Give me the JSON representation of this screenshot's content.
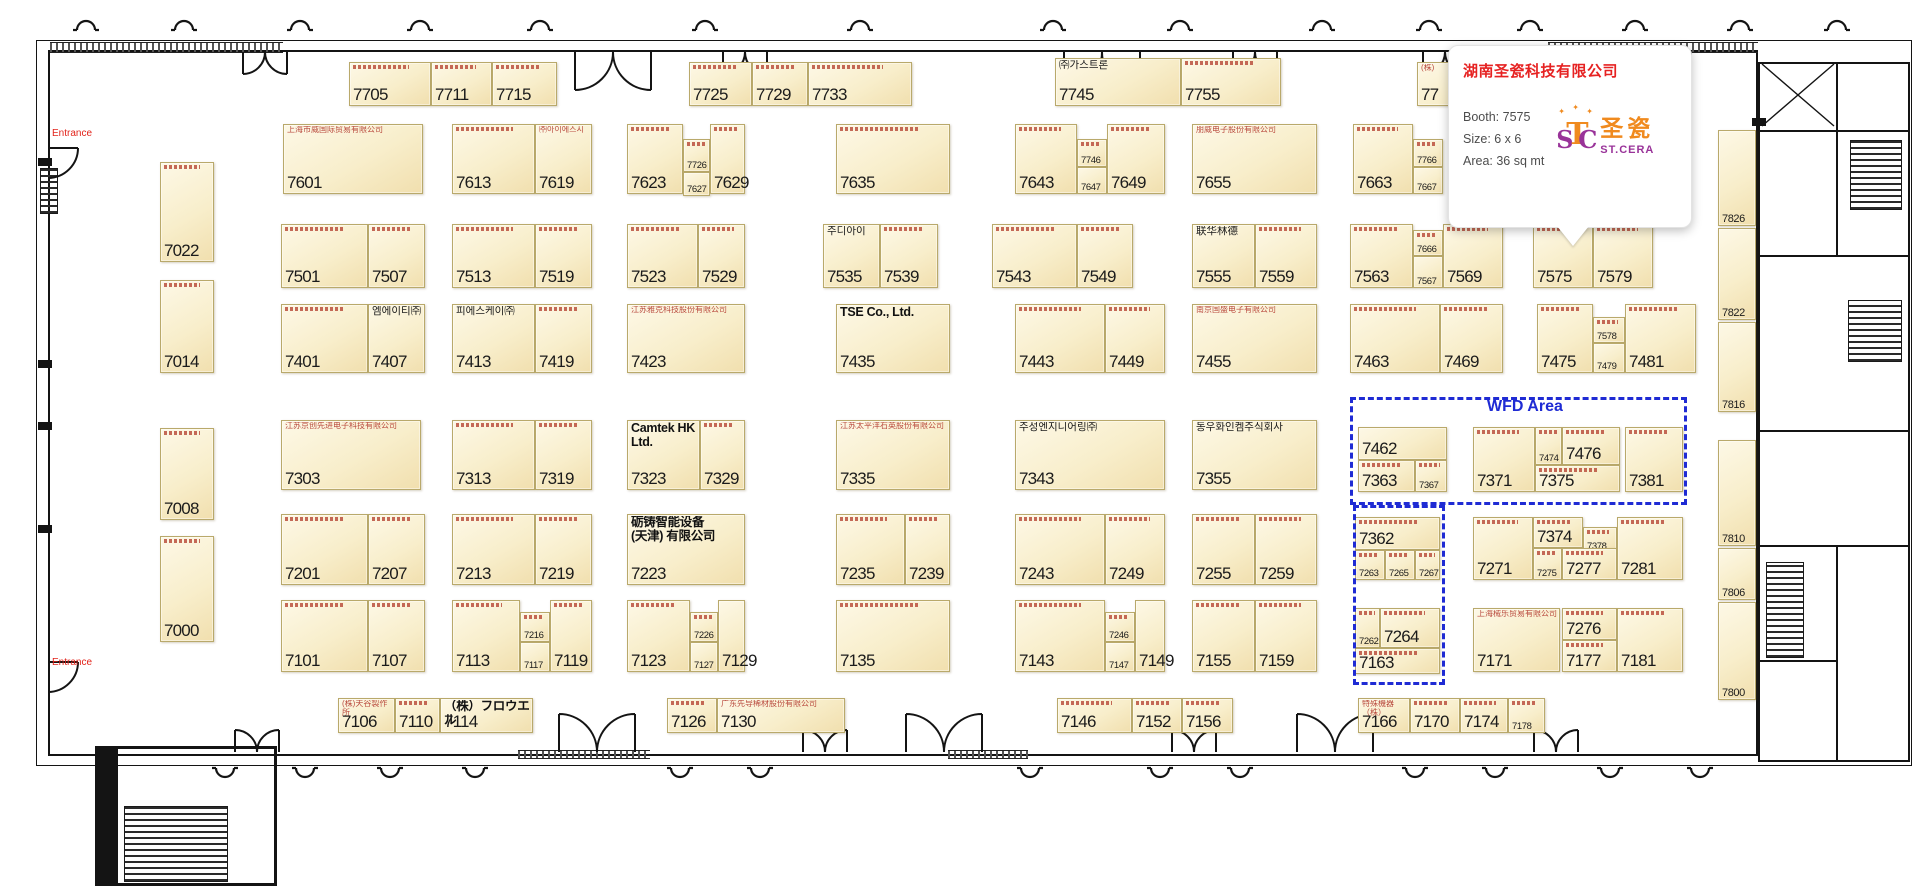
{
  "colors": {
    "dash_blue": "#1f2bd4",
    "entrance_red": "#e2231a",
    "tooltip_title_red": "#e62222",
    "logo_orange": "#f08a1e",
    "logo_purple": "#993399",
    "booth_fill": "#f8eecb",
    "booth_border": "#b9a96b"
  },
  "tooltip": {
    "title": "湖南圣瓷科技有限公司",
    "booth": "Booth: 7575",
    "size": "Size: 6 x 6",
    "area": "Area: 36 sq mt",
    "logo_monogram_s": "S",
    "logo_monogram_t": "T",
    "logo_monogram_c": "C",
    "logo_cn": "圣瓷",
    "logo_en": "ST.CERA",
    "spark": "✦"
  },
  "labels": {
    "wfd_area": "WFD Area",
    "entrance_top": "Entrance",
    "entrance_bottom": "Entrance"
  },
  "booths": [
    [
      "7705",
      349,
      62,
      82,
      44,
      "lg",
      null,
      null,
      1
    ],
    [
      "7711",
      431,
      62,
      61,
      44,
      "lg",
      null,
      null,
      1
    ],
    [
      "7715",
      492,
      62,
      65,
      44,
      "lg",
      null,
      null,
      1
    ],
    [
      "7725",
      689,
      62,
      63,
      44,
      "lg",
      null,
      null,
      1
    ],
    [
      "7729",
      752,
      62,
      56,
      44,
      "lg",
      null,
      null,
      1
    ],
    [
      "7733",
      808,
      62,
      104,
      44,
      "lg",
      null,
      null,
      1
    ],
    [
      "7745",
      1055,
      58,
      126,
      48,
      "lg",
      "㈜가스트론",
      "k",
      0
    ],
    [
      "7755",
      1181,
      58,
      100,
      48,
      "lg",
      null,
      null,
      1
    ],
    [
      "77",
      1417,
      62,
      95,
      44,
      "lg",
      "(株)",
      "r",
      0
    ],
    [
      "7022",
      160,
      162,
      54,
      100,
      "lg",
      null,
      null,
      1
    ],
    [
      "7014",
      160,
      280,
      54,
      93,
      "lg",
      null,
      null,
      1
    ],
    [
      "7008",
      160,
      428,
      54,
      92,
      "lg",
      null,
      null,
      1
    ],
    [
      "7000",
      160,
      536,
      54,
      106,
      "lg",
      null,
      null,
      1
    ],
    [
      "7601",
      283,
      124,
      140,
      70,
      "lg",
      "上海市威国际贸易有限公司",
      "r",
      0
    ],
    [
      "7613",
      452,
      124,
      83,
      70,
      "lg",
      null,
      null,
      1
    ],
    [
      "7619",
      535,
      124,
      57,
      70,
      "lg",
      "㈜아이에스시",
      "r",
      0
    ],
    [
      "7623",
      627,
      124,
      56,
      70,
      "lg",
      null,
      null,
      1
    ],
    [
      "7726",
      683,
      139,
      27,
      33,
      "xs",
      null,
      null,
      1
    ],
    [
      "7627",
      683,
      172,
      27,
      24,
      "xs",
      null,
      null,
      0
    ],
    [
      "7629",
      710,
      124,
      35,
      70,
      "lg",
      null,
      null,
      1
    ],
    [
      "7635",
      836,
      124,
      114,
      70,
      "lg",
      null,
      null,
      1
    ],
    [
      "7643",
      1015,
      124,
      62,
      70,
      "lg",
      null,
      null,
      1
    ],
    [
      "7746",
      1077,
      139,
      30,
      28,
      "xs",
      null,
      null,
      1
    ],
    [
      "7647",
      1077,
      167,
      30,
      27,
      "xs",
      null,
      null,
      0
    ],
    [
      "7649",
      1107,
      124,
      58,
      70,
      "lg",
      null,
      null,
      1
    ],
    [
      "7655",
      1192,
      124,
      125,
      70,
      "lg",
      "朋威电子股份有限公司",
      "r",
      0
    ],
    [
      "7663",
      1353,
      124,
      60,
      70,
      "lg",
      null,
      null,
      1
    ],
    [
      "7766",
      1413,
      139,
      30,
      28,
      "xs",
      null,
      null,
      1
    ],
    [
      "7667",
      1413,
      167,
      30,
      27,
      "xs",
      null,
      null,
      0
    ],
    [
      "7501",
      281,
      224,
      87,
      64,
      "lg",
      null,
      null,
      1
    ],
    [
      "7507",
      368,
      224,
      57,
      64,
      "lg",
      null,
      null,
      1
    ],
    [
      "7513",
      452,
      224,
      83,
      64,
      "lg",
      null,
      null,
      1
    ],
    [
      "7519",
      535,
      224,
      57,
      64,
      "lg",
      null,
      null,
      1
    ],
    [
      "7523",
      627,
      224,
      71,
      64,
      "lg",
      null,
      null,
      1
    ],
    [
      "7529",
      698,
      224,
      47,
      64,
      "lg",
      null,
      null,
      1
    ],
    [
      "7535",
      823,
      224,
      57,
      64,
      "lg",
      "주디아이",
      "k",
      0
    ],
    [
      "7539",
      880,
      224,
      58,
      64,
      "lg",
      null,
      null,
      1
    ],
    [
      "7543",
      992,
      224,
      85,
      64,
      "lg",
      null,
      null,
      1
    ],
    [
      "7549",
      1077,
      224,
      56,
      64,
      "lg",
      null,
      null,
      1
    ],
    [
      "7555",
      1192,
      224,
      63,
      64,
      "lg",
      "联华林德",
      "k",
      0
    ],
    [
      "7559",
      1255,
      224,
      62,
      64,
      "lg",
      null,
      null,
      1
    ],
    [
      "7563",
      1350,
      224,
      63,
      64,
      "lg",
      null,
      null,
      1
    ],
    [
      "7666",
      1413,
      230,
      30,
      26,
      "xs",
      null,
      null,
      1
    ],
    [
      "7567",
      1413,
      256,
      30,
      32,
      "xs",
      null,
      null,
      0
    ],
    [
      "7569",
      1443,
      224,
      60,
      64,
      "lg",
      null,
      null,
      1
    ],
    [
      "7575",
      1533,
      224,
      60,
      64,
      "lg",
      null,
      null,
      1
    ],
    [
      "7579",
      1593,
      224,
      60,
      64,
      "lg",
      null,
      null,
      1
    ],
    [
      "7401",
      281,
      304,
      87,
      69,
      "lg",
      null,
      null,
      1
    ],
    [
      "7407",
      368,
      304,
      57,
      69,
      "lg",
      "엠에이티㈜",
      "k",
      0
    ],
    [
      "7413",
      452,
      304,
      83,
      69,
      "lg",
      "피에스케이㈜",
      "k",
      0
    ],
    [
      "7419",
      535,
      304,
      57,
      69,
      "lg",
      null,
      null,
      1
    ],
    [
      "7423",
      627,
      304,
      118,
      69,
      "lg",
      "江苏雅克科技股份有限公司",
      "r",
      0
    ],
    [
      "7435",
      836,
      304,
      114,
      69,
      "lg",
      "TSE Co., Ltd.",
      "kb",
      0
    ],
    [
      "7443",
      1015,
      304,
      90,
      69,
      "lg",
      null,
      null,
      1
    ],
    [
      "7449",
      1105,
      304,
      60,
      69,
      "lg",
      null,
      null,
      1
    ],
    [
      "7455",
      1192,
      304,
      125,
      69,
      "lg",
      "南京国盛电子有限公司",
      "r",
      0
    ],
    [
      "7463",
      1350,
      304,
      90,
      69,
      "lg",
      null,
      null,
      1
    ],
    [
      "7469",
      1440,
      304,
      63,
      69,
      "lg",
      null,
      null,
      1
    ],
    [
      "7475",
      1537,
      304,
      56,
      69,
      "lg",
      null,
      null,
      1
    ],
    [
      "7578",
      1593,
      317,
      32,
      26,
      "xs",
      null,
      null,
      1
    ],
    [
      "7479",
      1593,
      343,
      32,
      30,
      "xs",
      null,
      null,
      0
    ],
    [
      "7481",
      1625,
      304,
      71,
      69,
      "lg",
      null,
      null,
      1
    ],
    [
      "7303",
      281,
      420,
      140,
      70,
      "lg",
      "江苏京创先进电子科技有限公司",
      "r",
      0
    ],
    [
      "7313",
      452,
      420,
      83,
      70,
      "lg",
      null,
      null,
      1
    ],
    [
      "7319",
      535,
      420,
      57,
      70,
      "lg",
      null,
      null,
      1
    ],
    [
      "7323",
      627,
      420,
      73,
      70,
      "lg",
      "Camtek HK\nLtd.",
      "kb",
      0
    ],
    [
      "7329",
      700,
      420,
      45,
      70,
      "lg",
      null,
      null,
      1
    ],
    [
      "7335",
      836,
      420,
      114,
      70,
      "lg",
      "江苏太平洋石英股份有限公司",
      "r",
      0
    ],
    [
      "7343",
      1015,
      420,
      150,
      70,
      "lg",
      "주성엔지니어링㈜",
      "k",
      0
    ],
    [
      "7355",
      1192,
      420,
      125,
      70,
      "lg",
      "동우화인켐주식회사",
      "k",
      0
    ],
    [
      "7462",
      1358,
      427,
      89,
      33,
      "lg",
      null,
      null,
      0
    ],
    [
      "7363",
      1358,
      460,
      57,
      32,
      "lg",
      null,
      null,
      1
    ],
    [
      "7367",
      1415,
      460,
      32,
      32,
      "xs",
      null,
      null,
      1
    ],
    [
      "7371",
      1473,
      427,
      62,
      65,
      "lg",
      null,
      null,
      1
    ],
    [
      "7474",
      1535,
      427,
      27,
      38,
      "xs",
      null,
      null,
      1
    ],
    [
      "7476",
      1562,
      427,
      58,
      38,
      "lg",
      null,
      null,
      1
    ],
    [
      "7375",
      1535,
      465,
      85,
      27,
      "lg",
      null,
      null,
      1
    ],
    [
      "7381",
      1625,
      427,
      58,
      65,
      "lg",
      null,
      null,
      1
    ],
    [
      "7201",
      281,
      514,
      87,
      71,
      "lg",
      null,
      null,
      1
    ],
    [
      "7207",
      368,
      514,
      57,
      71,
      "lg",
      null,
      null,
      1
    ],
    [
      "7213",
      452,
      514,
      83,
      71,
      "lg",
      null,
      null,
      1
    ],
    [
      "7219",
      535,
      514,
      57,
      71,
      "lg",
      null,
      null,
      1
    ],
    [
      "7223",
      627,
      514,
      118,
      71,
      "lg",
      "砺铸智能设备\n(天津) 有限公司",
      "kb",
      0
    ],
    [
      "7235",
      836,
      514,
      69,
      71,
      "lg",
      null,
      null,
      1
    ],
    [
      "7239",
      905,
      514,
      45,
      71,
      "lg",
      null,
      null,
      1
    ],
    [
      "7243",
      1015,
      514,
      90,
      71,
      "lg",
      null,
      null,
      1
    ],
    [
      "7249",
      1105,
      514,
      60,
      71,
      "lg",
      null,
      null,
      1
    ],
    [
      "7255",
      1192,
      514,
      63,
      71,
      "lg",
      null,
      null,
      1
    ],
    [
      "7259",
      1255,
      514,
      62,
      71,
      "lg",
      null,
      null,
      1
    ],
    [
      "7362",
      1355,
      517,
      85,
      33,
      "lg",
      null,
      null,
      1
    ],
    [
      "7263",
      1355,
      550,
      30,
      30,
      "xs",
      null,
      null,
      1
    ],
    [
      "7265",
      1385,
      550,
      30,
      30,
      "xs",
      null,
      null,
      1
    ],
    [
      "7267",
      1415,
      550,
      25,
      30,
      "xs",
      null,
      null,
      1
    ],
    [
      "7271",
      1473,
      517,
      60,
      63,
      "lg",
      null,
      null,
      1
    ],
    [
      "7374",
      1533,
      517,
      50,
      31,
      "lg",
      null,
      null,
      1
    ],
    [
      "7378",
      1583,
      527,
      34,
      26,
      "xs",
      null,
      null,
      1
    ],
    [
      "7275",
      1533,
      548,
      29,
      32,
      "xs",
      null,
      null,
      1
    ],
    [
      "7277",
      1562,
      548,
      55,
      32,
      "lg",
      null,
      null,
      1
    ],
    [
      "7281",
      1617,
      517,
      66,
      63,
      "lg",
      null,
      null,
      1
    ],
    [
      "7101",
      281,
      600,
      87,
      72,
      "lg",
      null,
      null,
      1
    ],
    [
      "7107",
      368,
      600,
      57,
      72,
      "lg",
      null,
      null,
      1
    ],
    [
      "7113",
      452,
      600,
      68,
      72,
      "lg",
      null,
      null,
      1
    ],
    [
      "7216",
      520,
      612,
      30,
      30,
      "xs",
      null,
      null,
      1
    ],
    [
      "7117",
      520,
      642,
      30,
      30,
      "xs",
      null,
      null,
      0
    ],
    [
      "7119",
      550,
      600,
      42,
      72,
      "lg",
      null,
      null,
      1
    ],
    [
      "7123",
      627,
      600,
      63,
      72,
      "lg",
      null,
      null,
      1
    ],
    [
      "7226",
      690,
      612,
      28,
      30,
      "xs",
      null,
      null,
      1
    ],
    [
      "7127",
      690,
      642,
      28,
      30,
      "xs",
      null,
      null,
      0
    ],
    [
      "7129",
      718,
      600,
      27,
      72,
      "lg",
      null,
      null,
      0
    ],
    [
      "7135",
      836,
      600,
      114,
      72,
      "lg",
      null,
      null,
      1
    ],
    [
      "7143",
      1015,
      600,
      90,
      72,
      "lg",
      null,
      null,
      1
    ],
    [
      "7246",
      1105,
      612,
      30,
      30,
      "xs",
      null,
      null,
      1
    ],
    [
      "7147",
      1105,
      642,
      30,
      30,
      "xs",
      null,
      null,
      0
    ],
    [
      "7149",
      1135,
      600,
      30,
      72,
      "lg",
      null,
      null,
      0
    ],
    [
      "7155",
      1192,
      600,
      63,
      72,
      "lg",
      null,
      null,
      1
    ],
    [
      "7159",
      1255,
      600,
      62,
      72,
      "lg",
      null,
      null,
      1
    ],
    [
      "7262",
      1355,
      608,
      25,
      40,
      "xs",
      null,
      null,
      1
    ],
    [
      "7264",
      1380,
      608,
      60,
      40,
      "lg",
      null,
      null,
      1
    ],
    [
      "7163",
      1355,
      648,
      85,
      26,
      "lg",
      null,
      null,
      1
    ],
    [
      "7171",
      1473,
      608,
      87,
      64,
      "lg",
      "上海械乐贸易有限公司",
      "r",
      0
    ],
    [
      "7276",
      1562,
      608,
      55,
      32,
      "lg",
      null,
      null,
      1
    ],
    [
      "7177",
      1562,
      640,
      55,
      32,
      "lg",
      null,
      null,
      1
    ],
    [
      "7181",
      1617,
      608,
      66,
      64,
      "lg",
      null,
      null,
      1
    ],
    [
      "7106",
      338,
      698,
      57,
      35,
      "lg",
      "(株)天谷製作所",
      "r",
      0
    ],
    [
      "7110",
      395,
      698,
      45,
      35,
      "lg",
      null,
      null,
      1
    ],
    [
      "7114",
      440,
      698,
      93,
      35,
      "lg",
      "（株）フロウエル",
      "kb",
      0
    ],
    [
      "7126",
      667,
      698,
      50,
      35,
      "lg",
      null,
      null,
      1
    ],
    [
      "7130",
      717,
      698,
      128,
      35,
      "lg",
      "广东先导稀材股份有限公司",
      "r",
      0
    ],
    [
      "7146",
      1057,
      698,
      75,
      35,
      "lg",
      null,
      null,
      1
    ],
    [
      "7152",
      1132,
      698,
      50,
      35,
      "lg",
      null,
      null,
      1
    ],
    [
      "7156",
      1182,
      698,
      51,
      35,
      "lg",
      null,
      null,
      1
    ],
    [
      "7166",
      1358,
      698,
      52,
      35,
      "lg",
      "特殊機器（株）",
      "r",
      0
    ],
    [
      "7170",
      1410,
      698,
      50,
      35,
      "lg",
      null,
      null,
      1
    ],
    [
      "7174",
      1460,
      698,
      48,
      35,
      "lg",
      null,
      null,
      1
    ],
    [
      "7178",
      1508,
      698,
      37,
      35,
      "xs",
      null,
      null,
      1
    ],
    [
      "7826",
      1718,
      130,
      38,
      96,
      "sm",
      null,
      null,
      0
    ],
    [
      "7822",
      1718,
      228,
      38,
      92,
      "sm",
      null,
      null,
      0
    ],
    [
      "7816",
      1718,
      322,
      38,
      90,
      "sm",
      null,
      null,
      0
    ],
    [
      "7810",
      1718,
      440,
      38,
      106,
      "sm",
      null,
      null,
      0
    ],
    [
      "7806",
      1718,
      548,
      38,
      52,
      "sm",
      null,
      null,
      0
    ],
    [
      "7800",
      1718,
      602,
      38,
      98,
      "sm",
      null,
      null,
      0
    ]
  ],
  "wfd_boxes": [
    {
      "x": 1350,
      "y": 397,
      "w": 337,
      "h": 108
    },
    {
      "x": 1353,
      "y": 505,
      "w": 92,
      "h": 180
    }
  ]
}
